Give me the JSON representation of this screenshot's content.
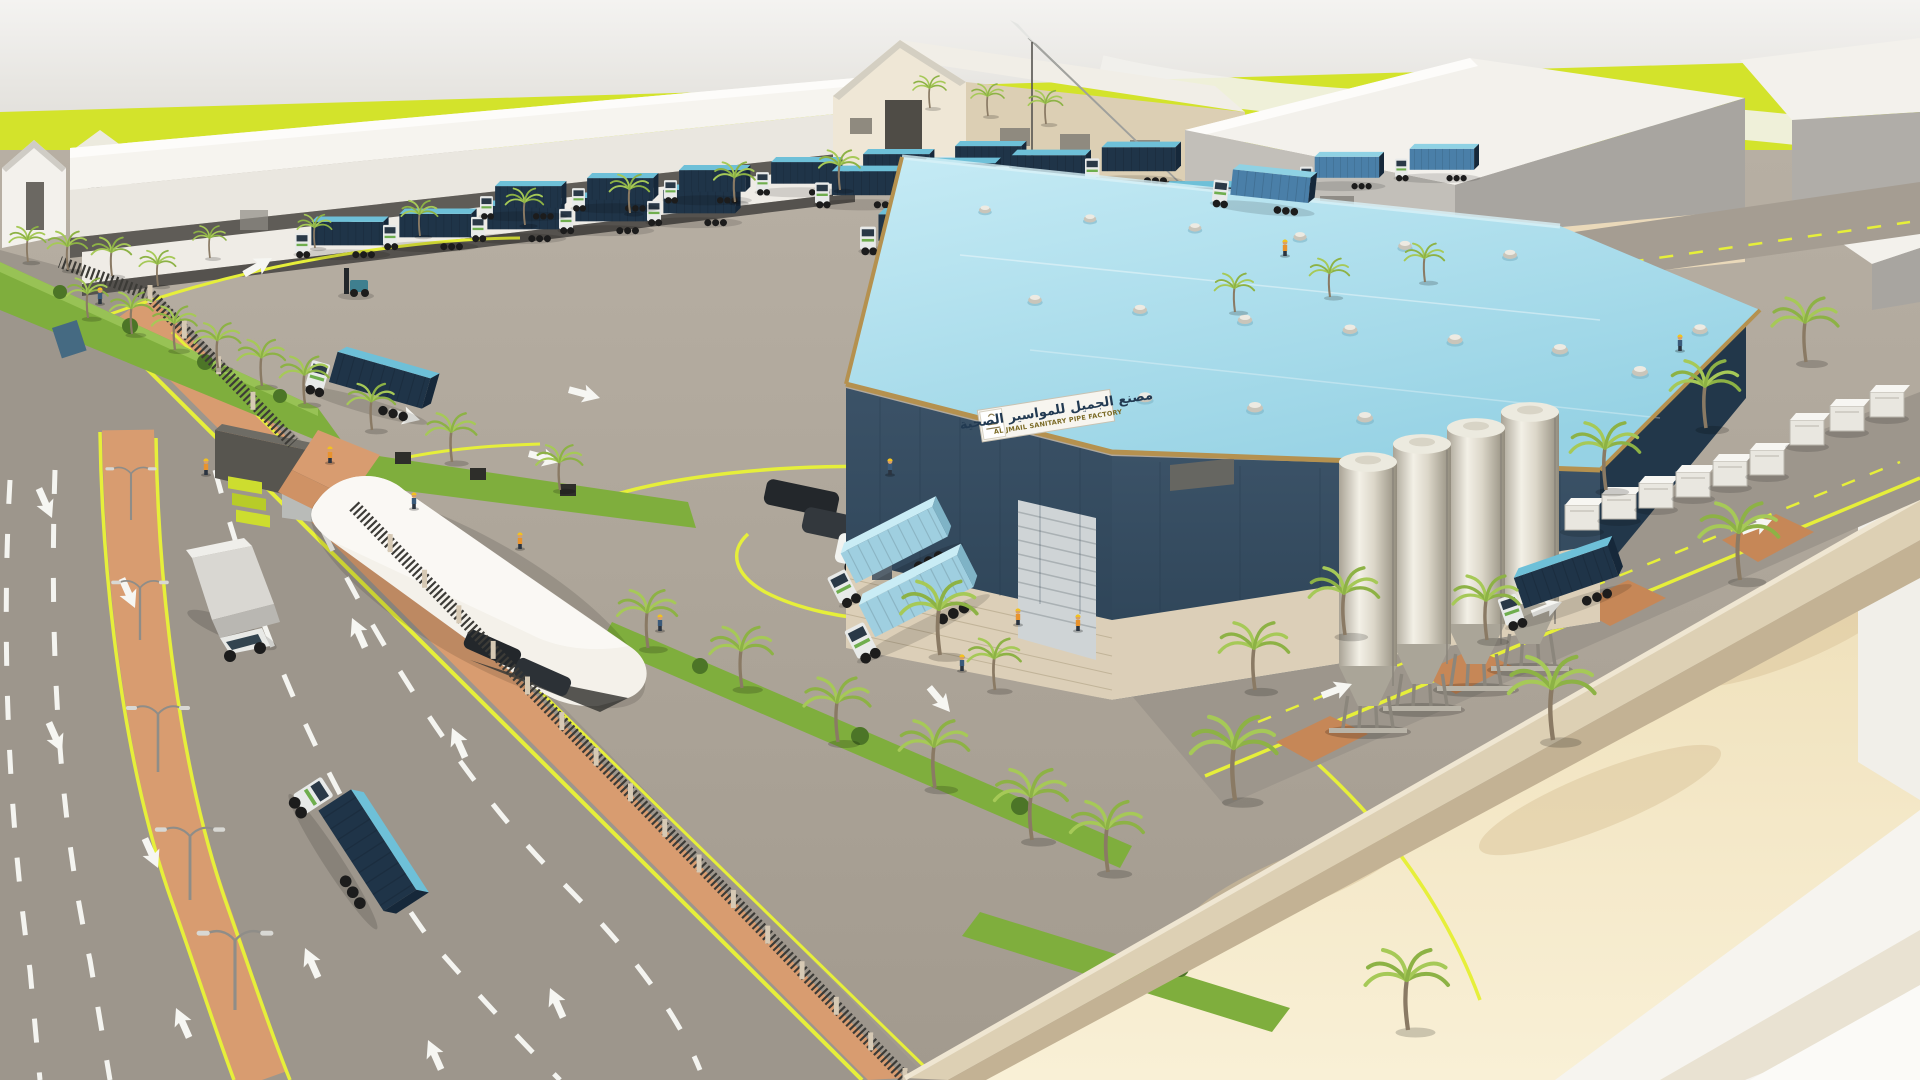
{
  "scene": {
    "description": "3D aerial architectural rendering of a sanitary pipe factory compound with trailer yard, mobile crane, silos, palm-lined roads and perimeter fence",
    "factory_sign": {
      "arabic": "مصنع الجميل للمواسير الصحية",
      "english": "AL JMAIL SANITARY PIPE FACTORY"
    },
    "palette": {
      "sky": "#f2f1ee",
      "field_lime": "#d3e32b",
      "roof_cyan": "#a7dcec",
      "roof_cyan_light": "#c6ebf5",
      "factory_navy": "#33495c",
      "factory_navy_dark": "#24384a",
      "factory_beige": "#dccfb8",
      "gold_trim": "#b5914f",
      "warehouse_white": "#f3f1ec",
      "warehouse_gray": "#b3b0ab",
      "yard": "#a89f93",
      "road": "#9d968c",
      "median_terracotta": "#d89c70",
      "sand": "#f3e6c2",
      "fence_dark": "#3c3b37",
      "wall_tan": "#cdbfa5",
      "green": "#7fae3d",
      "palm_frond": "#9cc04c",
      "palm_trunk": "#8a7a64",
      "trailer_navy": "#1f3448",
      "trailer_teal": "#6ec0d8",
      "container_light_blue": "#9fcfe0",
      "cab_white": "#e8eae9",
      "guide_yellow": "#e6ef3a",
      "silo_metal": "#d8d4c8",
      "crane_gray": "#d2d3cf",
      "hivis_orange": "#e8932e",
      "helmet_yellow": "#f2c21f"
    },
    "objects": {
      "silo_count": 4,
      "roof_vents": [
        [
          985,
          210,
          0.75
        ],
        [
          1090,
          219,
          0.78
        ],
        [
          1195,
          228,
          0.8
        ],
        [
          1300,
          237,
          0.82
        ],
        [
          1405,
          246,
          0.85
        ],
        [
          1510,
          255,
          0.88
        ],
        [
          1035,
          300,
          0.85
        ],
        [
          1140,
          310,
          0.88
        ],
        [
          1245,
          320,
          0.9
        ],
        [
          1350,
          330,
          0.92
        ],
        [
          1455,
          340,
          0.95
        ],
        [
          1560,
          350,
          1
        ],
        [
          1145,
          398,
          0.95
        ],
        [
          1255,
          408,
          1
        ],
        [
          1365,
          418,
          1
        ],
        [
          1640,
          372,
          1
        ],
        [
          1700,
          330,
          0.95
        ]
      ],
      "trailer_rows": [
        {
          "x": 295,
          "y": 250,
          "n": 5,
          "dx": 88,
          "dy": -8,
          "s": 0.78,
          "v": "navy"
        },
        {
          "x": 480,
          "y": 212,
          "n": 6,
          "dx": 92,
          "dy": -8,
          "s": 0.72,
          "v": "navy"
        },
        {
          "x": 815,
          "y": 200,
          "n": 4,
          "dx": 90,
          "dy": -8,
          "s": 0.8,
          "v": "navy"
        },
        {
          "x": 860,
          "y": 246,
          "n": 4,
          "dx": 95,
          "dy": -9,
          "s": 0.88,
          "v": "navy"
        },
        {
          "x": 1300,
          "y": 182,
          "n": 2,
          "dx": 95,
          "dy": -8,
          "s": 0.7,
          "v": "mid"
        }
      ],
      "single_trucks": [
        {
          "x": 306,
          "y": 382,
          "rot": 16,
          "s": 1.05,
          "v": "navy",
          "name": "gate-truck"
        },
        {
          "x": 1212,
          "y": 198,
          "rot": 6,
          "s": 0.85,
          "v": "mid",
          "name": "backroad-truck"
        },
        {
          "x": 1505,
          "y": 622,
          "rot": -19,
          "s": 1.08,
          "v": "navy",
          "name": "silo-road-truck"
        },
        {
          "x": 297,
          "y": 792,
          "rot": 57,
          "s": 1.3,
          "v": "navy",
          "name": "street-truck"
        },
        {
          "x": 838,
          "y": 600,
          "rot": -27,
          "s": 1.12,
          "v": "light",
          "name": "dock-truck-rear"
        },
        {
          "x": 856,
          "y": 655,
          "rot": -27,
          "s": 1.2,
          "v": "light",
          "name": "dock-truck-front"
        }
      ],
      "palms": [
        [
          210,
          258,
          0.5
        ],
        [
          315,
          248,
          0.52
        ],
        [
          420,
          236,
          0.55
        ],
        [
          525,
          225,
          0.57
        ],
        [
          630,
          213,
          0.6
        ],
        [
          735,
          202,
          0.62
        ],
        [
          840,
          190,
          0.62
        ],
        [
          28,
          262,
          0.55
        ],
        [
          68,
          270,
          0.6
        ],
        [
          112,
          276,
          0.6
        ],
        [
          158,
          286,
          0.55
        ],
        [
          88,
          318,
          0.62
        ],
        [
          132,
          334,
          0.65
        ],
        [
          175,
          350,
          0.68
        ],
        [
          218,
          368,
          0.7
        ],
        [
          262,
          386,
          0.72
        ],
        [
          305,
          404,
          0.74
        ],
        [
          372,
          430,
          0.72
        ],
        [
          452,
          462,
          0.76
        ],
        [
          560,
          490,
          0.7
        ],
        [
          648,
          648,
          0.9
        ],
        [
          742,
          688,
          0.95
        ],
        [
          838,
          742,
          1.0
        ],
        [
          935,
          788,
          1.05
        ],
        [
          1032,
          840,
          1.1
        ],
        [
          1108,
          872,
          1.1
        ],
        [
          940,
          655,
          1.15
        ],
        [
          995,
          690,
          0.8
        ],
        [
          1487,
          640,
          1.0
        ],
        [
          1806,
          362,
          1.0
        ],
        [
          1706,
          428,
          1.05
        ],
        [
          1606,
          490,
          1.05
        ],
        [
          1345,
          635,
          1.05
        ],
        [
          1255,
          690,
          1.05
        ],
        [
          1235,
          800,
          1.3
        ],
        [
          1553,
          740,
          1.3
        ],
        [
          1740,
          580,
          1.2
        ],
        [
          1408,
          1030,
          1.25
        ],
        [
          1235,
          312,
          0.6
        ],
        [
          1330,
          297,
          0.6
        ],
        [
          1425,
          282,
          0.6
        ],
        [
          930,
          108,
          0.5
        ],
        [
          988,
          116,
          0.5
        ],
        [
          1046,
          124,
          0.52
        ]
      ],
      "workers": [
        [
          100,
          303
        ],
        [
          206,
          474
        ],
        [
          660,
          630
        ],
        [
          1018,
          624
        ],
        [
          962,
          670
        ],
        [
          1078,
          630
        ],
        [
          890,
          474
        ],
        [
          330,
          462
        ],
        [
          414,
          508
        ],
        [
          1285,
          255
        ],
        [
          1680,
          350
        ],
        [
          520,
          548
        ]
      ],
      "arrows": [
        [
          52,
          518,
          156
        ],
        [
          135,
          608,
          156
        ],
        [
          62,
          752,
          156
        ],
        [
          158,
          868,
          156
        ],
        [
          352,
          618,
          336
        ],
        [
          452,
          728,
          336
        ],
        [
          176,
          1008,
          336
        ],
        [
          305,
          948,
          336
        ],
        [
          428,
          1040,
          336
        ],
        [
          550,
          988,
          336
        ],
        [
          420,
          420,
          105
        ],
        [
          560,
          462,
          105
        ],
        [
          272,
          258,
          60
        ],
        [
          950,
          712,
          140
        ],
        [
          600,
          398,
          105
        ],
        [
          1352,
          684,
          69
        ],
        [
          1562,
          602,
          69
        ],
        [
          1772,
          520,
          69
        ]
      ],
      "lamps": [
        [
          131,
          520,
          0.8
        ],
        [
          140,
          640,
          0.9
        ],
        [
          158,
          772,
          1.0
        ],
        [
          190,
          900,
          1.1
        ],
        [
          235,
          1010,
          1.2
        ]
      ],
      "silos": [
        [
          1530,
          412,
          29,
          192
        ],
        [
          1476,
          428,
          29,
          196
        ],
        [
          1422,
          444,
          29,
          200
        ],
        [
          1368,
          462,
          29,
          204
        ]
      ]
    }
  }
}
